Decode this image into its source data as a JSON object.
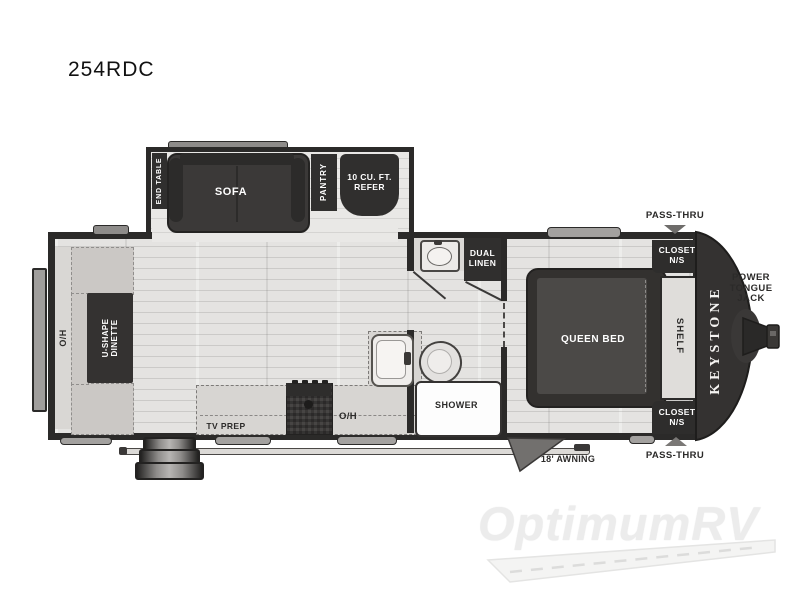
{
  "page": {
    "title": "254RDC"
  },
  "floorplan": {
    "model": "254RDC",
    "labels": {
      "end_table": "END TABLE",
      "sofa": "SOFA",
      "pantry": "PANTRY",
      "refer": "10 CU. FT. REFER",
      "dual_linen": "DUAL LINEN",
      "closet_ns_top": "CLOSET N/S",
      "closet_ns_bottom": "CLOSET N/S",
      "pass_thru_top": "PASS-THRU",
      "pass_thru_bottom": "PASS-THRU",
      "power_tongue_jack": "POWER TONGUE JACK",
      "queen_bed": "QUEEN BED",
      "shelf": "SHELF",
      "brand": "KEYSTONE",
      "u_shape_dinette": "U-SHAPE DINETTE",
      "oh_rear": "O/H",
      "oh_kitchen": "O/H",
      "tv_prep": "TV PREP",
      "shower": "SHOWER",
      "awning": "18' AWNING"
    },
    "colors": {
      "wall_dark": "#2b2a29",
      "furniture_dark": "#3b3938",
      "floor": "#e4e3e1",
      "counter": "#d7d5d2",
      "bench": "#cbc8c5",
      "window_gray": "#a3a19f",
      "label_dark": "#2b2a29",
      "label_light": "#ffffff"
    }
  },
  "watermark": {
    "brand": "OptimumRV"
  }
}
